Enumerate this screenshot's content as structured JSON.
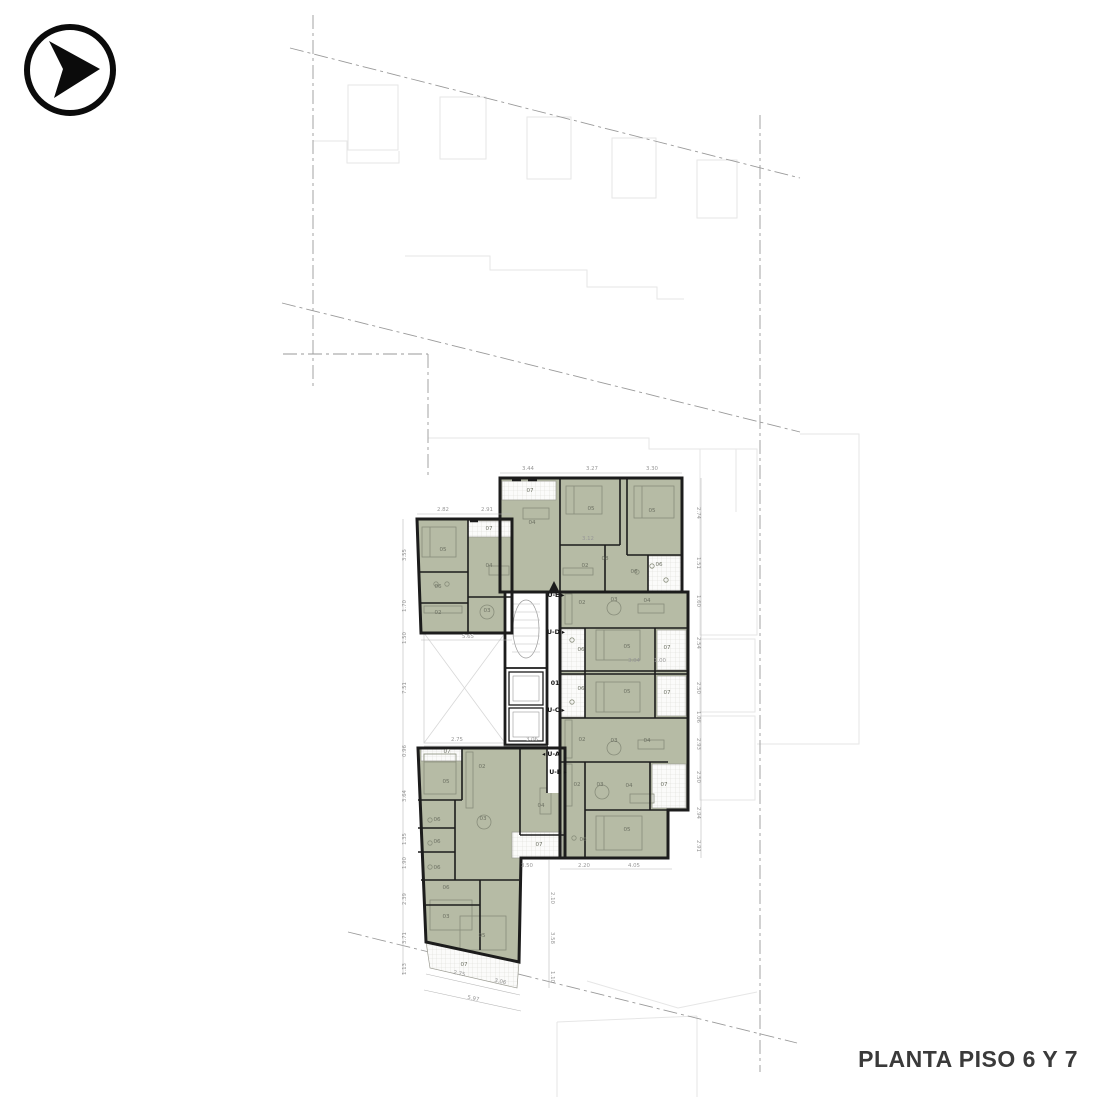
{
  "title": "PLANTA PISO 6 Y 7",
  "logo_icon": "arrow-right-circle",
  "colors": {
    "room_fill": "#b6bba5",
    "wall": "#1c1c1c",
    "dimension_text": "#979797",
    "boundary_line": "#9a9a9a",
    "neighbor_outline": "#e6e6e6",
    "title_text": "#3a3a3a"
  },
  "corridor": {
    "label": "01"
  },
  "unit_labels": [
    {
      "label": "U-E",
      "x": 556,
      "y": 597,
      "arrow": "right"
    },
    {
      "label": "U-D",
      "x": 556,
      "y": 634,
      "arrow": "right"
    },
    {
      "label": "01",
      "x": 555,
      "y": 685,
      "arrow": "none"
    },
    {
      "label": "U-C",
      "x": 556,
      "y": 712,
      "arrow": "right"
    },
    {
      "label": "U-A",
      "x": 551,
      "y": 756,
      "arrow": "left"
    },
    {
      "label": "U-B",
      "x": 558,
      "y": 774,
      "arrow": "right"
    }
  ],
  "room_labels": [
    {
      "label": "05",
      "x": 443,
      "y": 551
    },
    {
      "label": "06",
      "x": 438,
      "y": 588
    },
    {
      "label": "02",
      "x": 438,
      "y": 614
    },
    {
      "label": "03",
      "x": 487,
      "y": 612
    },
    {
      "label": "04",
      "x": 489,
      "y": 567
    },
    {
      "label": "07",
      "x": 489,
      "y": 530
    },
    {
      "label": "07",
      "x": 530,
      "y": 492
    },
    {
      "label": "04",
      "x": 532,
      "y": 524
    },
    {
      "label": "05",
      "x": 591,
      "y": 510
    },
    {
      "label": "05",
      "x": 652,
      "y": 512
    },
    {
      "label": "02",
      "x": 585,
      "y": 567
    },
    {
      "label": "08",
      "x": 605,
      "y": 560
    },
    {
      "label": "06",
      "x": 634,
      "y": 573
    },
    {
      "label": "06",
      "x": 659,
      "y": 566
    },
    {
      "label": "02",
      "x": 582,
      "y": 604
    },
    {
      "label": "03",
      "x": 614,
      "y": 601
    },
    {
      "label": "04",
      "x": 647,
      "y": 602
    },
    {
      "label": "06",
      "x": 581,
      "y": 651
    },
    {
      "label": "05",
      "x": 627,
      "y": 648
    },
    {
      "label": "07",
      "x": 667,
      "y": 649
    },
    {
      "label": "06",
      "x": 581,
      "y": 690
    },
    {
      "label": "05",
      "x": 627,
      "y": 693
    },
    {
      "label": "07",
      "x": 667,
      "y": 694
    },
    {
      "label": "02",
      "x": 582,
      "y": 741
    },
    {
      "label": "03",
      "x": 614,
      "y": 742
    },
    {
      "label": "04",
      "x": 647,
      "y": 742
    },
    {
      "label": "02",
      "x": 577,
      "y": 786
    },
    {
      "label": "03",
      "x": 600,
      "y": 786
    },
    {
      "label": "04",
      "x": 629,
      "y": 787
    },
    {
      "label": "07",
      "x": 664,
      "y": 786
    },
    {
      "label": "05",
      "x": 627,
      "y": 831
    },
    {
      "label": "06",
      "x": 583,
      "y": 841
    },
    {
      "label": "07",
      "x": 447,
      "y": 753
    },
    {
      "label": "05",
      "x": 446,
      "y": 783
    },
    {
      "label": "02",
      "x": 482,
      "y": 768
    },
    {
      "label": "03",
      "x": 483,
      "y": 820
    },
    {
      "label": "04",
      "x": 541,
      "y": 807
    },
    {
      "label": "06",
      "x": 437,
      "y": 821
    },
    {
      "label": "06",
      "x": 437,
      "y": 843
    },
    {
      "label": "06",
      "x": 437,
      "y": 869
    },
    {
      "label": "07",
      "x": 539,
      "y": 846
    },
    {
      "label": "06",
      "x": 446,
      "y": 889
    },
    {
      "label": "03",
      "x": 446,
      "y": 918
    },
    {
      "label": "05",
      "x": 482,
      "y": 937
    },
    {
      "label": "07",
      "x": 464,
      "y": 966
    }
  ],
  "dimensions": [
    {
      "text": "3.44",
      "x": 528,
      "y": 470,
      "rot": 0
    },
    {
      "text": "3.27",
      "x": 592,
      "y": 470,
      "rot": 0
    },
    {
      "text": "3.30",
      "x": 652,
      "y": 470,
      "rot": 0
    },
    {
      "text": "2.82",
      "x": 443,
      "y": 511,
      "rot": 0
    },
    {
      "text": "2.91",
      "x": 487,
      "y": 511,
      "rot": 0
    },
    {
      "text": "2.74",
      "x": 697,
      "y": 513,
      "rot": 90
    },
    {
      "text": "1.51",
      "x": 697,
      "y": 563,
      "rot": 90
    },
    {
      "text": "1.60",
      "x": 697,
      "y": 601,
      "rot": 90
    },
    {
      "text": "2.54",
      "x": 697,
      "y": 643,
      "rot": 90
    },
    {
      "text": "2.50",
      "x": 697,
      "y": 688,
      "rot": 90
    },
    {
      "text": "1.06",
      "x": 697,
      "y": 717,
      "rot": 90
    },
    {
      "text": "2.93",
      "x": 697,
      "y": 744,
      "rot": 90
    },
    {
      "text": "2.50",
      "x": 697,
      "y": 777,
      "rot": 90
    },
    {
      "text": "2.94",
      "x": 697,
      "y": 813,
      "rot": 90
    },
    {
      "text": "2.91",
      "x": 697,
      "y": 846,
      "rot": 90
    },
    {
      "text": "3.55",
      "x": 406,
      "y": 555,
      "rot": -90
    },
    {
      "text": "1.70",
      "x": 406,
      "y": 606,
      "rot": -90
    },
    {
      "text": "1.50",
      "x": 406,
      "y": 638,
      "rot": -90
    },
    {
      "text": "7.51",
      "x": 406,
      "y": 688,
      "rot": -90
    },
    {
      "text": "0.96",
      "x": 406,
      "y": 751,
      "rot": -90
    },
    {
      "text": "3.64",
      "x": 406,
      "y": 796,
      "rot": -90
    },
    {
      "text": "1.35",
      "x": 406,
      "y": 839,
      "rot": -90
    },
    {
      "text": "1.90",
      "x": 406,
      "y": 863,
      "rot": -90
    },
    {
      "text": "2.39",
      "x": 406,
      "y": 899,
      "rot": -90
    },
    {
      "text": "3.71",
      "x": 406,
      "y": 938,
      "rot": -90
    },
    {
      "text": "1.13",
      "x": 406,
      "y": 969,
      "rot": -90
    },
    {
      "text": "5.65",
      "x": 468,
      "y": 638,
      "rot": 0
    },
    {
      "text": "2.75",
      "x": 457,
      "y": 741,
      "rot": 0
    },
    {
      "text": "3.06",
      "x": 532,
      "y": 741,
      "rot": 0
    },
    {
      "text": "3.12",
      "x": 588,
      "y": 540,
      "rot": 0
    },
    {
      "text": "3.04",
      "x": 634,
      "y": 662,
      "rot": 0
    },
    {
      "text": "1.00",
      "x": 660,
      "y": 662,
      "rot": 0
    },
    {
      "text": "3.50",
      "x": 527,
      "y": 867,
      "rot": 0
    },
    {
      "text": "2.20",
      "x": 584,
      "y": 867,
      "rot": 0
    },
    {
      "text": "4.05",
      "x": 634,
      "y": 867,
      "rot": 0
    },
    {
      "text": "2.10",
      "x": 551,
      "y": 898,
      "rot": 90
    },
    {
      "text": "3.58",
      "x": 551,
      "y": 938,
      "rot": 90
    },
    {
      "text": "1.10",
      "x": 551,
      "y": 977,
      "rot": 90
    },
    {
      "text": "2.75",
      "x": 459,
      "y": 975,
      "rot": 12
    },
    {
      "text": "3.06",
      "x": 500,
      "y": 983,
      "rot": 12
    },
    {
      "text": "5.97",
      "x": 473,
      "y": 1000,
      "rot": 12
    }
  ]
}
